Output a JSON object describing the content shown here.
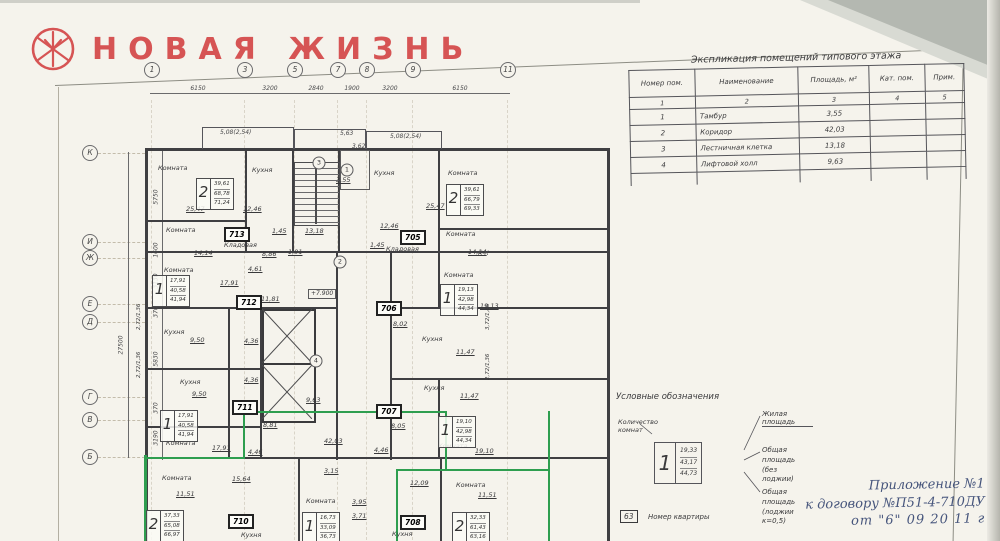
{
  "colors": {
    "logo_red": "#d65454",
    "marker_green": "#2e9e4f",
    "ink_blue": "#46557c",
    "paper": "#f5f3ec"
  },
  "logo": {
    "brand": "НОВАЯ ЖИЗНЬ"
  },
  "plan": {
    "grid_top": {
      "cols": [
        {
          "l": "1",
          "x": 152
        },
        {
          "l": "3",
          "x": 245
        },
        {
          "l": "5",
          "x": 295
        },
        {
          "l": "7",
          "x": 338
        },
        {
          "l": "8",
          "x": 367
        },
        {
          "l": "9",
          "x": 413
        },
        {
          "l": "11",
          "x": 508
        }
      ],
      "dims": [
        {
          "t": "6150",
          "x": 198
        },
        {
          "t": "3200",
          "x": 270
        },
        {
          "t": "2840",
          "x": 316
        },
        {
          "t": "1900",
          "x": 352
        },
        {
          "t": "3200",
          "x": 390
        },
        {
          "t": "6150",
          "x": 460
        }
      ]
    },
    "grid_left": {
      "rows": [
        {
          "l": "К",
          "y": 153
        },
        {
          "l": "И",
          "y": 242
        },
        {
          "l": "Ж",
          "y": 258
        },
        {
          "l": "Е",
          "y": 304
        },
        {
          "l": "Д",
          "y": 322
        },
        {
          "l": "Г",
          "y": 397
        },
        {
          "l": "В",
          "y": 420
        },
        {
          "l": "Б",
          "y": 457
        }
      ],
      "dims": [
        {
          "t": "5750",
          "y": 197
        },
        {
          "t": "1600",
          "y": 250
        },
        {
          "t": "3130",
          "y": 281
        },
        {
          "t": "370",
          "y": 312
        },
        {
          "t": "5830",
          "y": 359
        },
        {
          "t": "370",
          "y": 408
        },
        {
          "t": "3190",
          "y": 438
        }
      ],
      "total": "27500"
    },
    "labels": [
      {
        "t": "Комната",
        "x": 158,
        "y": 165
      },
      {
        "t": "25,47",
        "x": 186,
        "y": 206,
        "c": "u"
      },
      {
        "t": "Кухня",
        "x": 252,
        "y": 167
      },
      {
        "t": "12,46",
        "x": 243,
        "y": 206,
        "c": "u"
      },
      {
        "t": "Комната",
        "x": 166,
        "y": 227
      },
      {
        "t": "14,14",
        "x": 194,
        "y": 250,
        "c": "u"
      },
      {
        "t": "Кладовая",
        "x": 224,
        "y": 242
      },
      {
        "t": "1,45",
        "x": 272,
        "y": 228,
        "c": "u"
      },
      {
        "t": "8,86",
        "x": 262,
        "y": 251,
        "c": "u"
      },
      {
        "t": "1,91",
        "x": 288,
        "y": 249,
        "c": "u"
      },
      {
        "t": "13,18",
        "x": 305,
        "y": 228,
        "c": "u"
      },
      {
        "t": "3,55",
        "x": 336,
        "y": 177,
        "c": "u"
      },
      {
        "t": "Кухня",
        "x": 374,
        "y": 170
      },
      {
        "t": "12,46",
        "x": 380,
        "y": 223,
        "c": "u"
      },
      {
        "t": "Комната",
        "x": 448,
        "y": 170
      },
      {
        "t": "25,47",
        "x": 426,
        "y": 203,
        "c": "u"
      },
      {
        "t": "1,45",
        "x": 370,
        "y": 242,
        "c": "u"
      },
      {
        "t": "Кладовая",
        "x": 386,
        "y": 246
      },
      {
        "t": "Комната",
        "x": 446,
        "y": 231
      },
      {
        "t": "14,14",
        "x": 468,
        "y": 249,
        "c": "u"
      },
      {
        "t": "Комната",
        "x": 164,
        "y": 267
      },
      {
        "t": "17,91",
        "x": 220,
        "y": 280,
        "c": "u"
      },
      {
        "t": "4,61",
        "x": 248,
        "y": 266,
        "c": "u"
      },
      {
        "t": "11,81",
        "x": 261,
        "y": 296,
        "c": "u"
      },
      {
        "t": "Комната",
        "x": 444,
        "y": 272
      },
      {
        "t": "19,13",
        "x": 480,
        "y": 303,
        "c": "u"
      },
      {
        "t": "8,02",
        "x": 393,
        "y": 321,
        "c": "u"
      },
      {
        "t": "Кухня",
        "x": 422,
        "y": 336
      },
      {
        "t": "11,47",
        "x": 456,
        "y": 349,
        "c": "u"
      },
      {
        "t": "Кухня",
        "x": 164,
        "y": 329
      },
      {
        "t": "9,50",
        "x": 190,
        "y": 337,
        "c": "u"
      },
      {
        "t": "4,36",
        "x": 244,
        "y": 338,
        "c": "u"
      },
      {
        "t": "Кухня",
        "x": 180,
        "y": 379
      },
      {
        "t": "9,50",
        "x": 192,
        "y": 391,
        "c": "u"
      },
      {
        "t": "4,36",
        "x": 244,
        "y": 377,
        "c": "u"
      },
      {
        "t": "8,81",
        "x": 263,
        "y": 422,
        "c": "u"
      },
      {
        "t": "9,63",
        "x": 306,
        "y": 397,
        "c": "u"
      },
      {
        "t": "Комната",
        "x": 166,
        "y": 440
      },
      {
        "t": "17,91",
        "x": 212,
        "y": 445,
        "c": "u"
      },
      {
        "t": "4,46",
        "x": 248,
        "y": 449,
        "c": "u"
      },
      {
        "t": "Кухня",
        "x": 424,
        "y": 385
      },
      {
        "t": "11,47",
        "x": 460,
        "y": 393,
        "c": "u"
      },
      {
        "t": "8,05",
        "x": 391,
        "y": 423,
        "c": "u"
      },
      {
        "t": "Комната",
        "x": 438,
        "y": 443
      },
      {
        "t": "19,10",
        "x": 475,
        "y": 448,
        "c": "u"
      },
      {
        "t": "4,46",
        "x": 374,
        "y": 447,
        "c": "u"
      },
      {
        "t": "42,03",
        "x": 324,
        "y": 438,
        "c": "u"
      },
      {
        "t": "3,15",
        "x": 324,
        "y": 468,
        "c": "u"
      },
      {
        "t": "15,64",
        "x": 232,
        "y": 476,
        "c": "u"
      },
      {
        "t": "Комната",
        "x": 162,
        "y": 475
      },
      {
        "t": "11,51",
        "x": 176,
        "y": 491,
        "c": "u"
      },
      {
        "t": "Комната",
        "x": 306,
        "y": 498
      },
      {
        "t": "3,95",
        "x": 352,
        "y": 499,
        "c": "u"
      },
      {
        "t": "3,71",
        "x": 352,
        "y": 513,
        "c": "u"
      },
      {
        "t": "12,09",
        "x": 410,
        "y": 480,
        "c": "u"
      },
      {
        "t": "Комната",
        "x": 456,
        "y": 482
      },
      {
        "t": "11,51",
        "x": 478,
        "y": 492,
        "c": "u"
      },
      {
        "t": "Кухня",
        "x": 241,
        "y": 532
      },
      {
        "t": "Кухня",
        "x": 392,
        "y": 531
      },
      {
        "t": "2,72/1,36",
        "x": 137,
        "y": 330,
        "c": "rot"
      },
      {
        "t": "2,72/1,36",
        "x": 137,
        "y": 378,
        "c": "rot"
      },
      {
        "t": "3,72/1,86",
        "x": 486,
        "y": 330,
        "c": "rot"
      },
      {
        "t": "2,72/1,36",
        "x": 486,
        "y": 380,
        "c": "rot"
      },
      {
        "t": "5,08(2,54)",
        "x": 220,
        "y": 130,
        "c": "dim"
      },
      {
        "t": "5,63",
        "x": 340,
        "y": 131,
        "c": "dim"
      },
      {
        "t": "5,08(2,54)",
        "x": 390,
        "y": 134,
        "c": "dim"
      },
      {
        "t": "3,62",
        "x": 352,
        "y": 144,
        "c": "dim"
      },
      {
        "t": "К-К",
        "x": 478,
        "y": 251,
        "c": "dim"
      },
      {
        "t": "3",
        "x": 319,
        "y": 163,
        "c": "circ"
      },
      {
        "t": "1",
        "x": 347,
        "y": 170,
        "c": "circ"
      },
      {
        "t": "2",
        "x": 340,
        "y": 262,
        "c": "circ"
      },
      {
        "t": "4",
        "x": 316,
        "y": 361,
        "c": "circ"
      },
      {
        "t": "+7.900",
        "x": 308,
        "y": 289,
        "c": "lvl"
      }
    ],
    "units": [
      {
        "x": 196,
        "y": 178,
        "d": "2",
        "v": [
          "39,61",
          "68,78",
          "71,24"
        ]
      },
      {
        "x": 446,
        "y": 184,
        "d": "2",
        "v": [
          "39,61",
          "66,79",
          "69,33"
        ]
      },
      {
        "x": 152,
        "y": 275,
        "d": "1",
        "v": [
          "17,91",
          "40,58",
          "41,94"
        ]
      },
      {
        "x": 440,
        "y": 284,
        "d": "1",
        "v": [
          "19,13",
          "42,98",
          "44,34"
        ]
      },
      {
        "x": 160,
        "y": 410,
        "d": "1",
        "v": [
          "17,91",
          "40,58",
          "41,94"
        ]
      },
      {
        "x": 438,
        "y": 416,
        "d": "1",
        "v": [
          "19,10",
          "42,98",
          "44,34"
        ]
      },
      {
        "x": 146,
        "y": 510,
        "d": "2",
        "v": [
          "37,33",
          "65,08",
          "66,97"
        ]
      },
      {
        "x": 302,
        "y": 512,
        "d": "1",
        "v": [
          "16,73",
          "33,09",
          "36,73"
        ]
      },
      {
        "x": 452,
        "y": 512,
        "d": "2",
        "v": [
          "32,33",
          "61,43",
          "63,16"
        ]
      }
    ],
    "unit_numbers": [
      {
        "x": 224,
        "y": 227,
        "n": "713"
      },
      {
        "x": 400,
        "y": 230,
        "n": "705"
      },
      {
        "x": 236,
        "y": 295,
        "n": "712"
      },
      {
        "x": 376,
        "y": 301,
        "n": "706"
      },
      {
        "x": 232,
        "y": 400,
        "n": "711"
      },
      {
        "x": 376,
        "y": 404,
        "n": "707"
      },
      {
        "x": 228,
        "y": 514,
        "n": "710"
      },
      {
        "x": 400,
        "y": 515,
        "n": "708"
      }
    ]
  },
  "table": {
    "title": "Экспликация помещений типового этажа",
    "headers": [
      "Номер пом.",
      "Наименование",
      "Площадь, м²",
      "Кат. пом.",
      "Прим."
    ],
    "colnums": [
      "1",
      "2",
      "3",
      "4",
      "5"
    ],
    "rows": [
      [
        "1",
        "Тамбур",
        "3,55",
        "",
        ""
      ],
      [
        "2",
        "Коридор",
        "42,03",
        "",
        ""
      ],
      [
        "3",
        "Лестничная клетка",
        "13,18",
        "",
        ""
      ],
      [
        "4",
        "Лифтовой холл",
        "9,63",
        "",
        ""
      ]
    ]
  },
  "legend": {
    "title": "Условные обозначения",
    "rooms_count_label": "Количество комнат",
    "sample": {
      "digit": "1",
      "values": [
        "19,33",
        "43,17",
        "44,73"
      ]
    },
    "living": "Жилая площадь",
    "total": "Общая площадь",
    "total_note": "(без лоджии)",
    "total2": "Общая площадь",
    "total2_note": "(лоджии к=0,5)",
    "apt_number_box": "63",
    "apt_number_label": "Номер квартиры"
  },
  "annotation": {
    "line1": "Приложение №1",
    "line2": "к договору №П51-4-710ДУ",
    "line3": "от \"6\"  09  20 11 г"
  }
}
